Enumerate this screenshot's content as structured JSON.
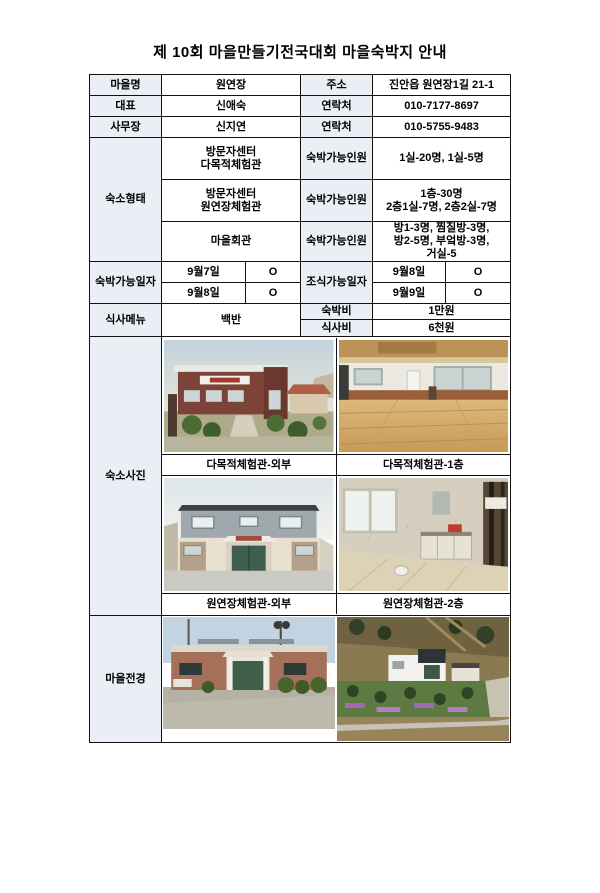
{
  "title": "제 10회 마을만들기전국대회 마을숙박지 안내",
  "colors": {
    "header_cell_bg": "#e9eff5",
    "border": "#111111",
    "text": "#000000"
  },
  "info_rows": [
    {
      "label": "마을명",
      "value": "원연장",
      "label2": "주소",
      "value2": "진안읍 원연장1길 21-1"
    },
    {
      "label": "대표",
      "value": "신애숙",
      "label2": "연락처",
      "value2": "010-7177-8697"
    },
    {
      "label": "사무장",
      "value": "신지연",
      "label2": "연락처",
      "value2": "010-5755-9483"
    }
  ],
  "lodging": {
    "label": "숙소형태",
    "capacity_label": "숙박가능인원",
    "rows": [
      {
        "facility": "방문자센터\n다목적체험관",
        "capacity": "1실-20명, 1실-5명"
      },
      {
        "facility": "방문자센터\n원연장체험관",
        "capacity": "1층-30명\n2층1실-7명, 2층2실-7명"
      },
      {
        "facility": "마을회관",
        "capacity": "방1-3명, 찜질방-3명,\n방2-5명, 부엌방-3명,\n거실-5"
      }
    ]
  },
  "dates": {
    "stay_label": "숙박가능일자",
    "stay": [
      {
        "date": "9월7일",
        "mark": "O"
      },
      {
        "date": "9월8일",
        "mark": "O"
      }
    ],
    "breakfast_label": "조식가능일자",
    "breakfast": [
      {
        "date": "9월8일",
        "mark": "O"
      },
      {
        "date": "9월9일",
        "mark": "O"
      }
    ]
  },
  "meals": {
    "menu_label": "식사메뉴",
    "menu": "백반",
    "stay_fee_label": "숙박비",
    "stay_fee": "1만원",
    "meal_fee_label": "식사비",
    "meal_fee": "6천원"
  },
  "photos": {
    "label": "숙소사진",
    "captions": [
      "다목적체험관-외부",
      "다목적체험관-1층",
      "원연장체험관-외부",
      "원연장체험관-2층"
    ]
  },
  "village": {
    "label": "마을전경"
  }
}
